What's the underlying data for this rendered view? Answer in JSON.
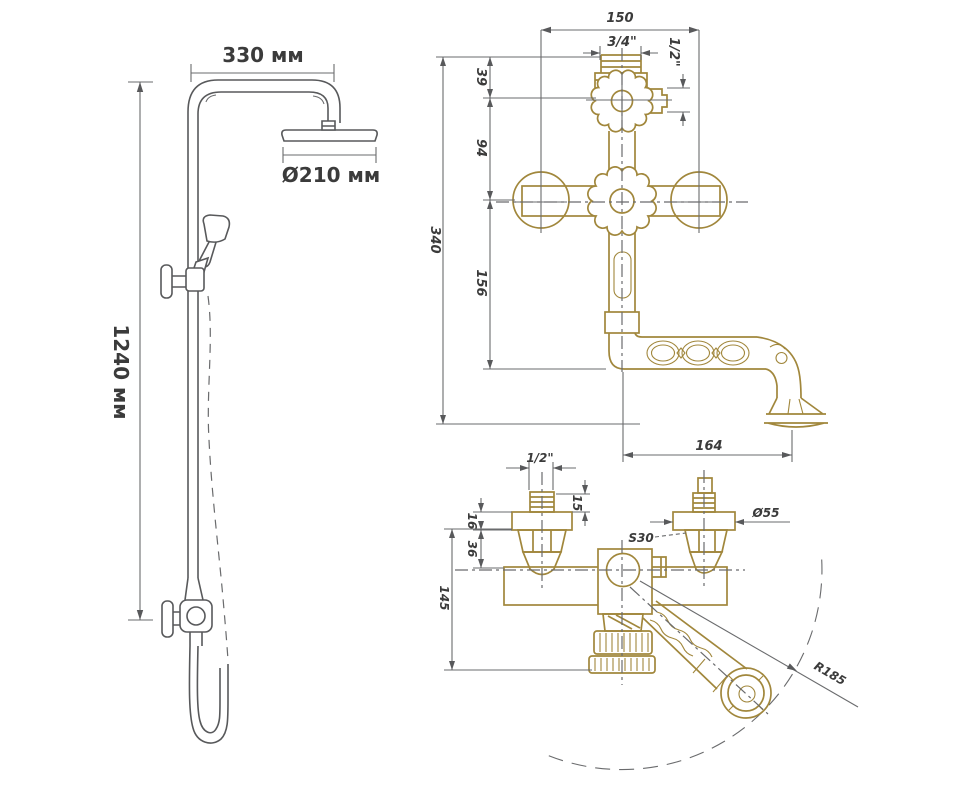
{
  "drawing": {
    "left_view": {
      "arm_width": "330 мм",
      "head_diameter": "Ø210 мм",
      "column_height": "1240 мм"
    },
    "front_view": {
      "inlet_spacing": "150",
      "top_thread": "3/4\"",
      "shower_outlet_thread": "1/2\"",
      "dim_39": "39",
      "dim_94": "94",
      "dim_156": "156",
      "overall_height": "340",
      "spout_reach": "164"
    },
    "side_view": {
      "inlet_thread": "1/2\"",
      "dim_15": "15",
      "dim_16": "16",
      "dim_36": "36",
      "overall_depth": "145",
      "hex_size": "S30",
      "flange_diameter": "Ø55",
      "swivel_radius": "R185"
    }
  },
  "colors": {
    "line_gray": "#58595b",
    "brass": "#a1873c",
    "text": "#3b3b3b",
    "background": "#ffffff"
  }
}
